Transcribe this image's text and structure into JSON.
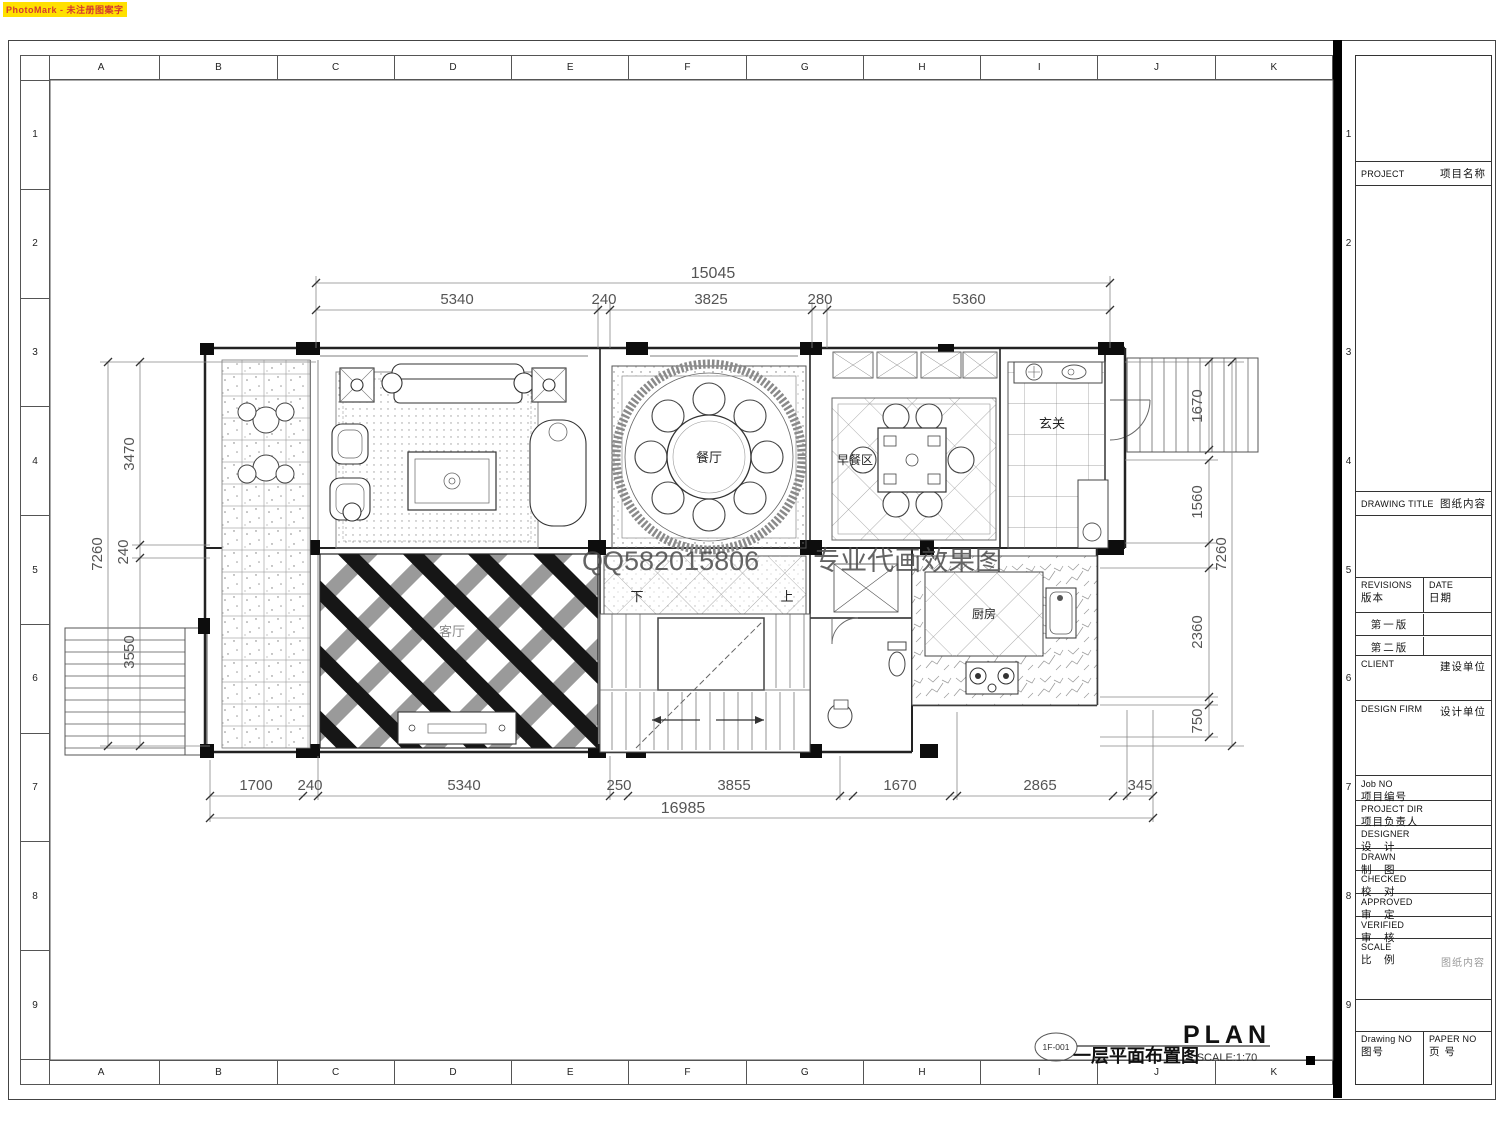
{
  "photomark": "PhotoMark - 未注册图案字",
  "grid": {
    "cols": [
      "A",
      "B",
      "C",
      "D",
      "E",
      "F",
      "G",
      "H",
      "I",
      "J",
      "K"
    ],
    "rows": [
      "1",
      "2",
      "3",
      "4",
      "5",
      "6",
      "7",
      "8",
      "9"
    ]
  },
  "watermark": "QQ582015806　　专业代画效果图",
  "rooms": {
    "living": "客厅",
    "dining": "餐厅",
    "breakfast": "早餐区",
    "foyer": "玄关",
    "kitchen": "厨房",
    "stair_up": "上",
    "stair_down": "下"
  },
  "dims": {
    "top": {
      "total": "15045",
      "segments": [
        "5340",
        "240",
        "3825",
        "280",
        "5360"
      ]
    },
    "bottom": {
      "total": "16985",
      "segments": [
        "1700",
        "240",
        "5340",
        "250",
        "3855",
        "1670",
        "2865",
        "345"
      ]
    },
    "left": {
      "overall": "7260",
      "segments": [
        "3470",
        "240",
        "3550"
      ]
    },
    "right": {
      "stair": "1670",
      "overall": "7260",
      "segments": [
        "1560",
        "2360",
        "750"
      ]
    }
  },
  "titlebar": {
    "tag": "1F-001",
    "name": "一层平面布置图",
    "plan": "PLAN",
    "scale": "SCALE:1:70"
  },
  "titleblock": {
    "project_en": "PROJECT",
    "project_cn": "项目名称",
    "drawing_title_en": "DRAWING TITLE",
    "drawing_title_cn": "图纸内容",
    "revisions_en": "REVISIONS",
    "revisions_cn": "版本",
    "date_en": "DATE",
    "date_cn": "日期",
    "rev1": "第一版",
    "rev2": "第二版",
    "client_en": "CLIENT",
    "client_cn": "建设单位",
    "design_firm_en": "DESIGN FIRM",
    "design_firm_cn": "设计单位",
    "job_no_en": "Job NO",
    "job_no_cn": "项目编号",
    "project_dir_en": "PROJECT DIR",
    "project_dir_cn": "项目负责人",
    "designer_en": "DESIGNER",
    "designer_cn": "设　计",
    "drawn_en": "DRAWN",
    "drawn_cn": "制　图",
    "checked_en": "CHECKED",
    "checked_cn": "校　对",
    "approved_en": "APPROVED",
    "approved_cn": "审　定",
    "verified_en": "VERIFIED",
    "verified_cn": "审　核",
    "scale_en": "SCALE",
    "scale_cn": "比　例",
    "scale_note": "图纸内容",
    "drawing_no_en": "Drawing NO",
    "drawing_no_cn": "图号",
    "paper_no_en": "PAPER NO",
    "paper_no_cn": "页 号"
  }
}
